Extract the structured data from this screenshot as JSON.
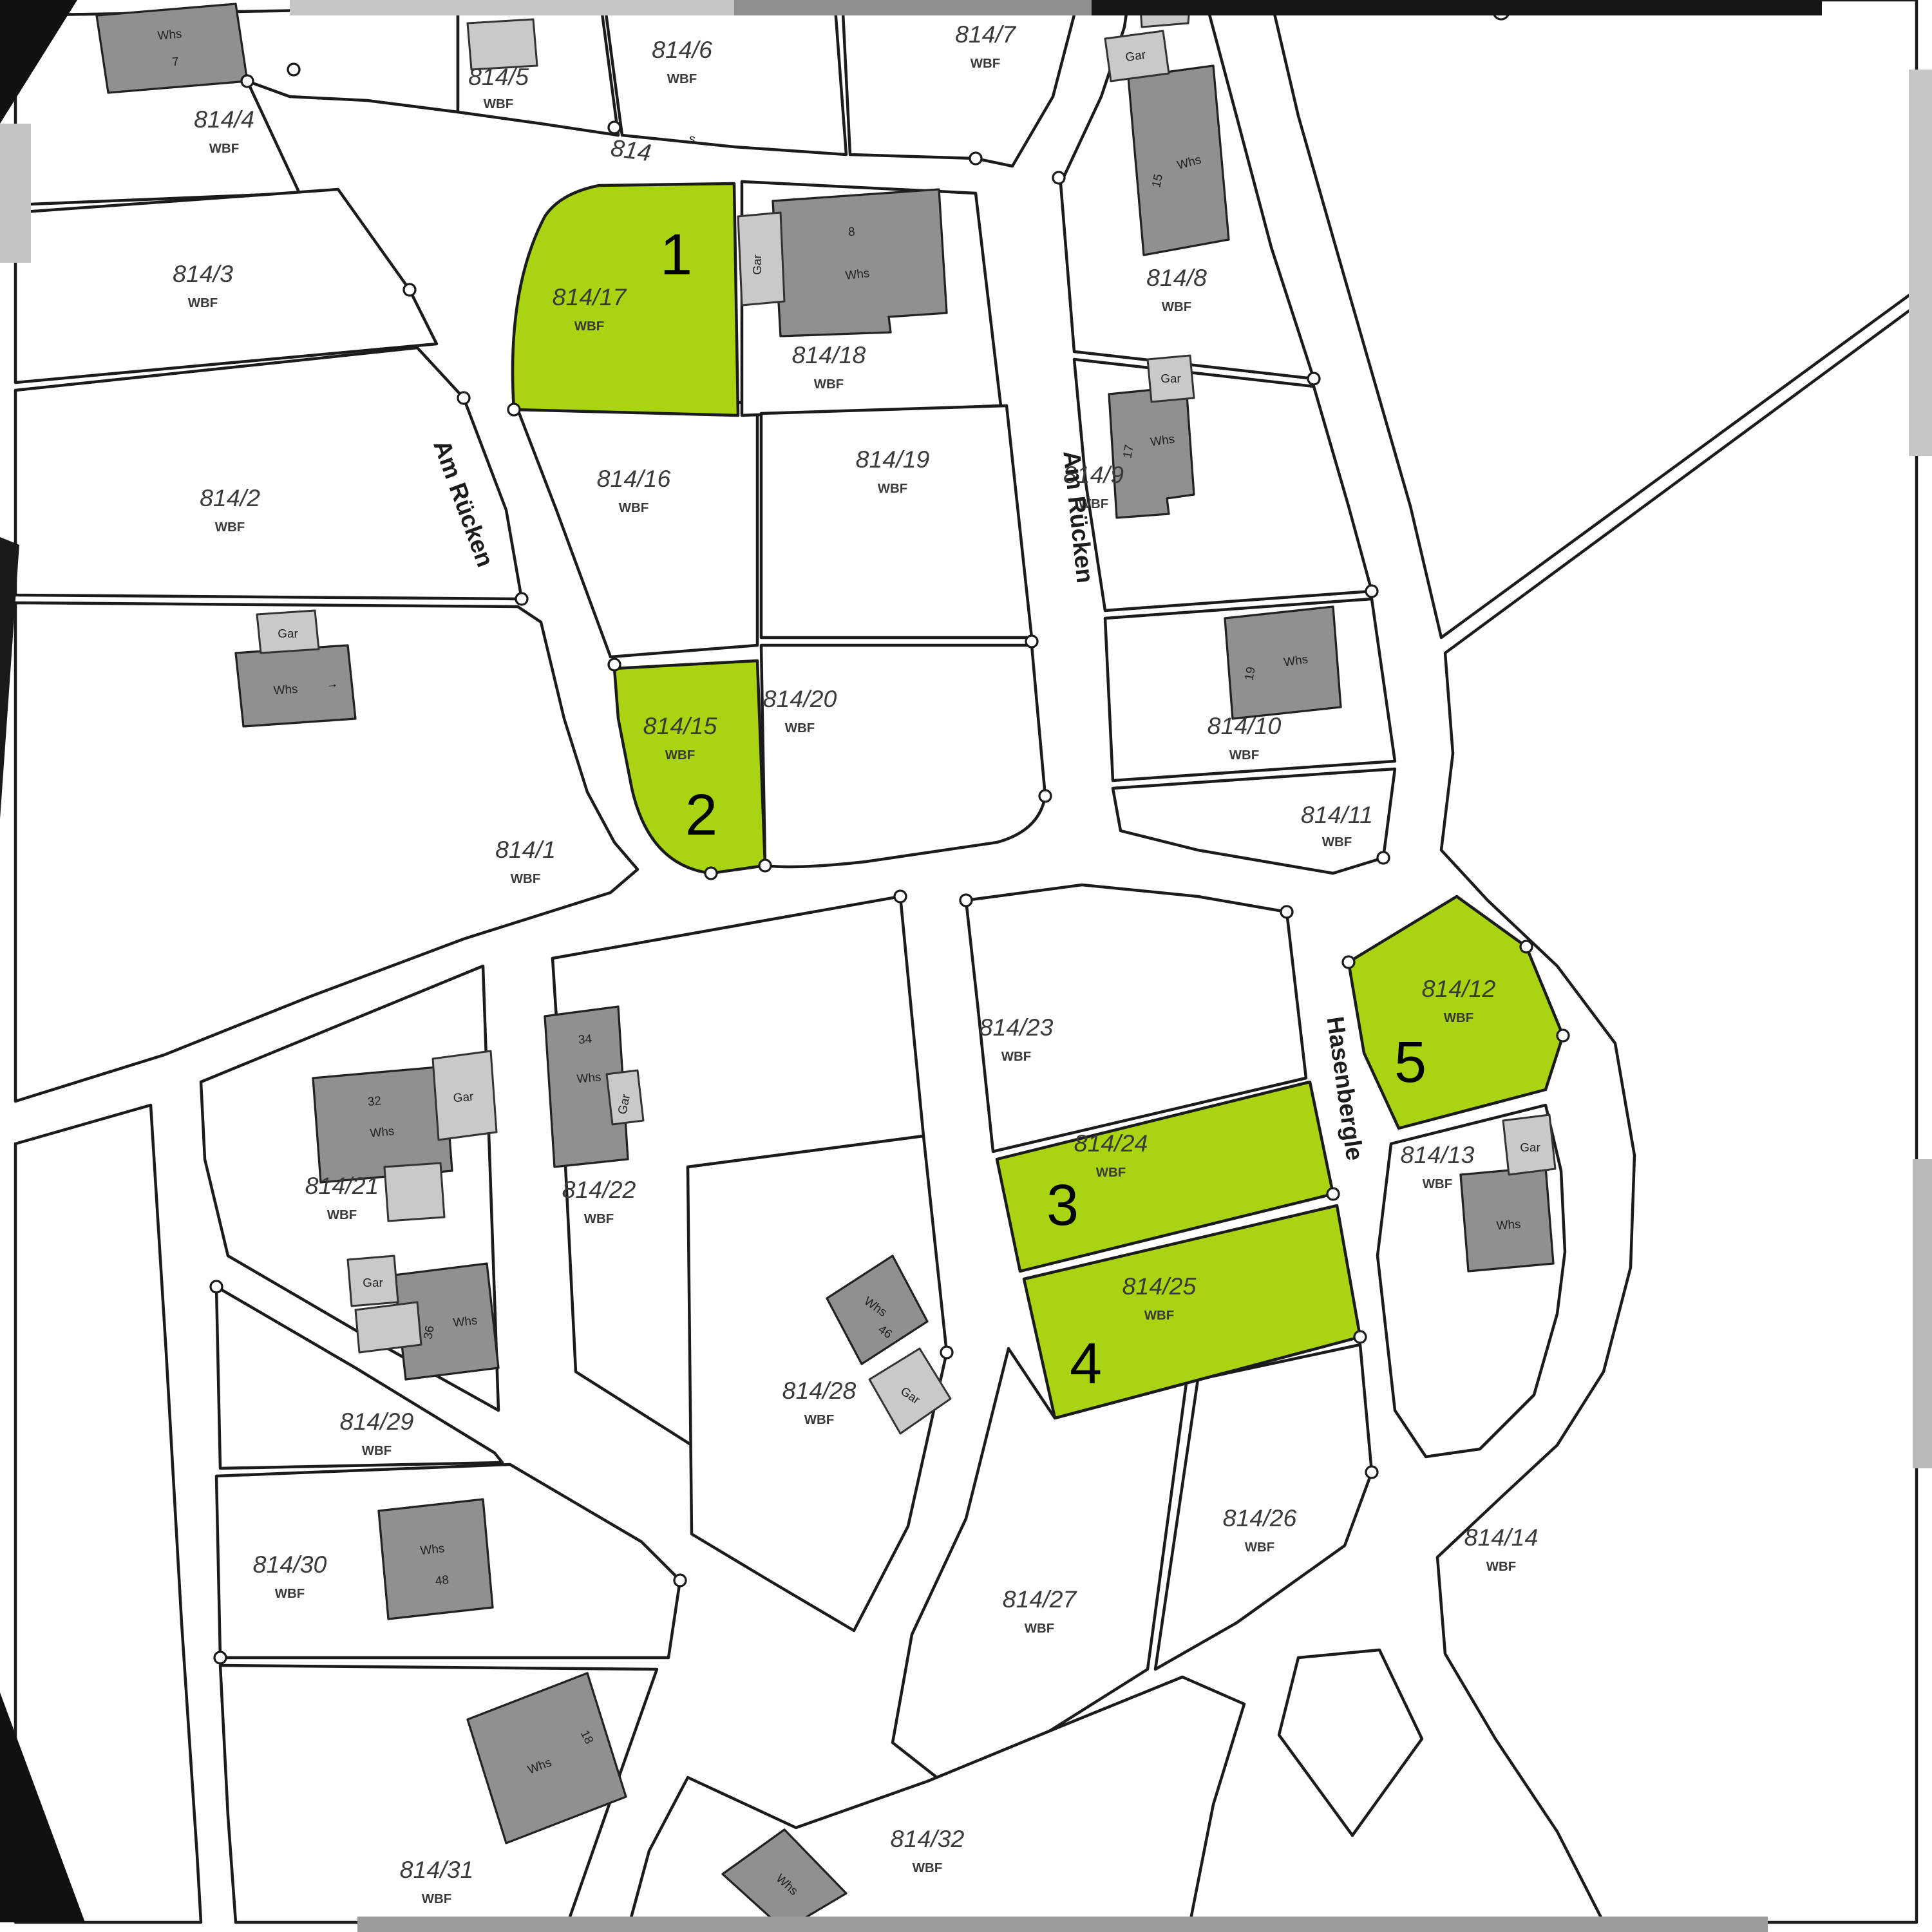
{
  "map": {
    "road_label": {
      "number": "814",
      "suffix": "s"
    },
    "streets": [
      {
        "name": "Am Rücken"
      },
      {
        "name": "Am Rücken"
      },
      {
        "name": "Hasenbergle"
      }
    ],
    "parcels": [
      {
        "id": "814/1",
        "code": "WBF"
      },
      {
        "id": "814/2",
        "code": "WBF"
      },
      {
        "id": "814/3",
        "code": "WBF"
      },
      {
        "id": "814/4",
        "code": "WBF"
      },
      {
        "id": "814/5",
        "code": "WBF"
      },
      {
        "id": "814/6",
        "code": "WBF"
      },
      {
        "id": "814/7",
        "code": "WBF"
      },
      {
        "id": "814/8",
        "code": "WBF"
      },
      {
        "id": "814/9",
        "code": "WBF"
      },
      {
        "id": "814/10",
        "code": "WBF"
      },
      {
        "id": "814/11",
        "code": "WBF"
      },
      {
        "id": "814/12",
        "code": "WBF"
      },
      {
        "id": "814/13",
        "code": "WBF"
      },
      {
        "id": "814/14",
        "code": "WBF"
      },
      {
        "id": "814/15",
        "code": "WBF"
      },
      {
        "id": "814/16",
        "code": "WBF"
      },
      {
        "id": "814/17",
        "code": "WBF"
      },
      {
        "id": "814/18",
        "code": "WBF"
      },
      {
        "id": "814/19",
        "code": "WBF"
      },
      {
        "id": "814/20",
        "code": "WBF"
      },
      {
        "id": "814/21",
        "code": "WBF"
      },
      {
        "id": "814/22",
        "code": "WBF"
      },
      {
        "id": "814/23",
        "code": "WBF"
      },
      {
        "id": "814/24",
        "code": "WBF"
      },
      {
        "id": "814/25",
        "code": "WBF"
      },
      {
        "id": "814/26",
        "code": "WBF"
      },
      {
        "id": "814/27",
        "code": "WBF"
      },
      {
        "id": "814/28",
        "code": "WBF"
      },
      {
        "id": "814/29",
        "code": "WBF"
      },
      {
        "id": "814/30",
        "code": "WBF"
      },
      {
        "id": "814/31",
        "code": "WBF"
      },
      {
        "id": "814/32",
        "code": "WBF"
      }
    ],
    "highlights": [
      {
        "number": "1",
        "parcel": "814/17"
      },
      {
        "number": "2",
        "parcel": "814/15"
      },
      {
        "number": "3",
        "parcel": "814/24"
      },
      {
        "number": "4",
        "parcel": "814/25"
      },
      {
        "number": "5",
        "parcel": "814/12"
      }
    ],
    "buildings": [
      {
        "label": "Whs",
        "number": "7"
      },
      {
        "label": "Gar",
        "number": ""
      },
      {
        "label": "Whs",
        "number": "8"
      },
      {
        "label": "Gar",
        "number": ""
      },
      {
        "label": "Whs",
        "number": "15"
      },
      {
        "label": "Gar",
        "number": ""
      },
      {
        "label": "Whs",
        "number": "17"
      },
      {
        "label": "Whs",
        "number": "19"
      },
      {
        "label": "Gar",
        "number": ""
      },
      {
        "label": "Whs",
        "number": "→"
      },
      {
        "label": "Gar",
        "number": ""
      },
      {
        "label": "Whs",
        "number": "32"
      },
      {
        "label": "Whs",
        "number": "34"
      },
      {
        "label": "Gar",
        "number": ""
      },
      {
        "label": "Gar",
        "number": ""
      },
      {
        "label": "Whs",
        "number": "36"
      },
      {
        "label": "Whs",
        "number": "46"
      },
      {
        "label": "Gar",
        "number": ""
      },
      {
        "label": "Whs",
        "number": "48"
      },
      {
        "label": "Whs",
        "number": "18"
      },
      {
        "label": "Whs",
        "number": ""
      },
      {
        "label": "Gar",
        "number": ""
      },
      {
        "label": "Whs",
        "number": ""
      }
    ],
    "colors": {
      "highlight_green": "#a9d411",
      "building_dark": "#909090",
      "building_light": "#c9c9c9",
      "boundary": "#1b1b1b"
    }
  }
}
